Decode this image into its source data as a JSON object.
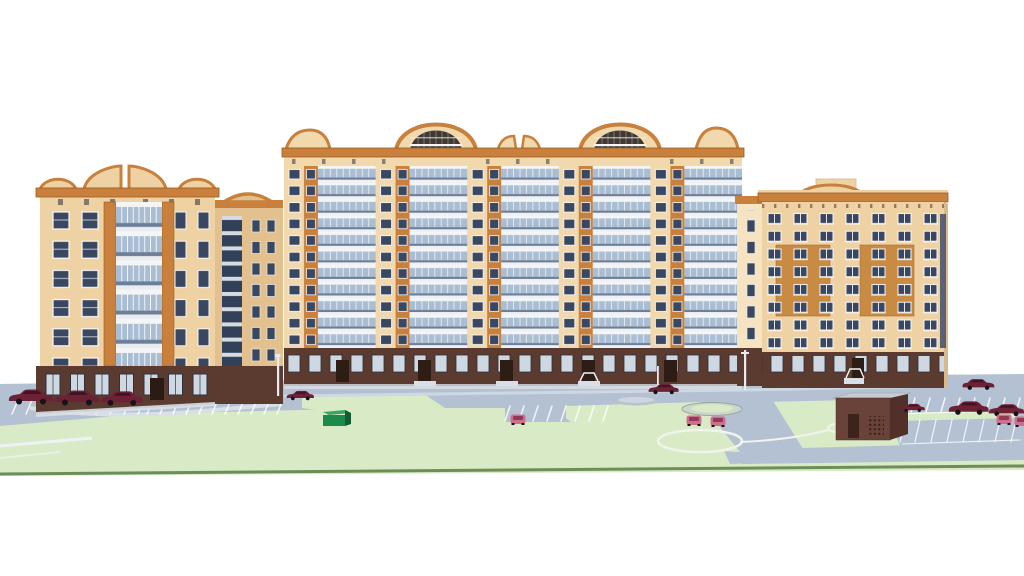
{
  "meta": {
    "title": "Residential complex — 3D architectural rendering",
    "description": "Computer rendering of a residential quarter: a left 8-story tower with an arched orange parapet, a long central 12-story building with two arched crowns and glazed balconies, a stair connector, and a right 9-story slab with orange inset panels; dark brick ground floors, light-green lawns, blue-grey driveways, striped parking stalls, maroon and pink cars, a green dumpster, a brick substation hut, round planters and street lamps."
  },
  "colors": {
    "cream": "#f2d8ad",
    "cream2": "#efd2a4",
    "cream3": "#f6e3c2",
    "creamShade": "#e2c18f",
    "orange": "#c8803c",
    "orangeDark": "#9a5c22",
    "panelOrange": "#c98b44",
    "winDark": "#3a4760",
    "winFrame": "#f6f7f9",
    "glass": "#a9bdd3",
    "glassDark": "#6c7f9a",
    "railWhite": "#f3f5f7",
    "baseBrown": "#5b3a30",
    "baseBrownDark": "#46291f",
    "baseWin": "#cdd8e3",
    "recess": "#413931",
    "lawn": "#d9ebc6",
    "lawnEdge": "#6d8f57",
    "road": "#b4c1d2",
    "sidewalk": "#d8dfe7",
    "stripe": "#ffffff",
    "maroon": "#6d2135",
    "maroonDark": "#401325",
    "pink": "#cf6f8e",
    "pinkDark": "#8e3c56",
    "green1": "#1d8a4c",
    "green1d": "#115c31",
    "green1l": "#3aa566",
    "substBrown": "#69423a",
    "substDark": "#503028",
    "substRoof": "#c8ccd2",
    "poleWhite": "#e8ecf0"
  },
  "scene": {
    "sky": "white",
    "buildings": [
      {
        "id": "left-tower",
        "floors": 8,
        "facade": "cream with orange pilasters",
        "crown": "double-arch orange parapet",
        "balconies": "central glazed stack",
        "base": "dark brick with shop windows"
      },
      {
        "id": "courtyard-wing",
        "floors": 9,
        "facade": "shaded cream",
        "feature": "dark glazed stairwell strip"
      },
      {
        "id": "central-slab",
        "floors": 12,
        "facade": "cream with orange spandrel columns",
        "crown": "two arched crowns with recessed dark loggias plus curved end parapets",
        "balconies": "continuous blue glazed bands"
      },
      {
        "id": "stair-connector",
        "floors": 9,
        "facade": "light cream"
      },
      {
        "id": "right-slab",
        "floors": 9,
        "facade": "cream with two orange inset window panels",
        "crown": "flat orange cornice with dentils, curved lift-shaft parapet"
      }
    ],
    "site": {
      "lawns": "light green with white path circles",
      "roads": "blue-grey asphalt loop with south service road",
      "parking": "white-striped stalls left, center and right",
      "objects": [
        "round planter ring",
        "grey entrance mound",
        "lawn circle paths",
        "brick substation hut",
        "green dumpster",
        "street lamps",
        "entrance porches"
      ]
    },
    "vehicles": {
      "maroon_sedans": 9,
      "pink_cars": 5
    }
  }
}
